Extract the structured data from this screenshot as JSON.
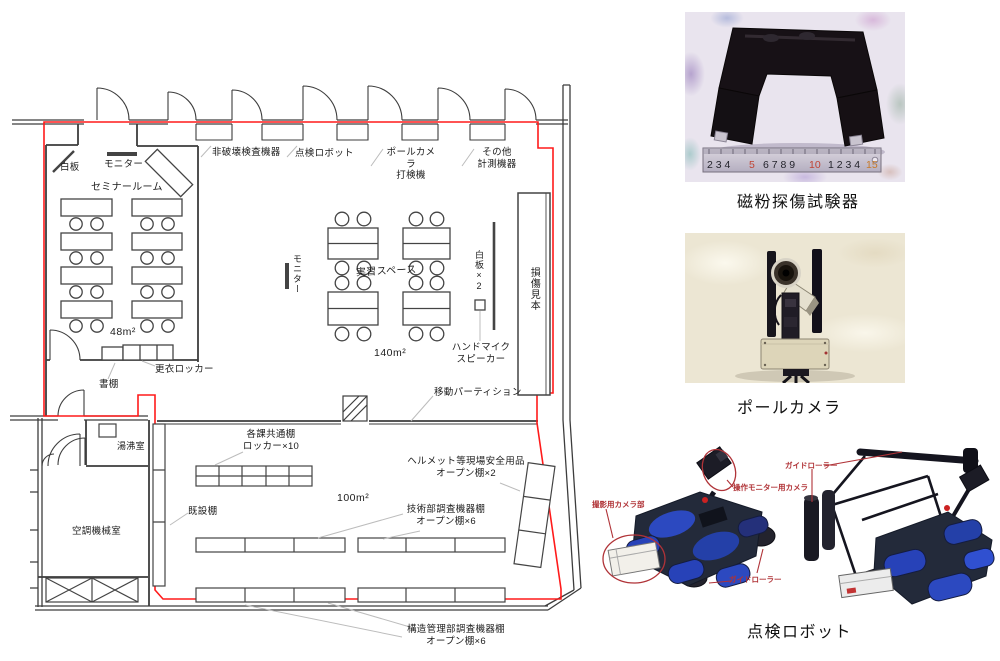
{
  "colors": {
    "boundary_red": "#ff1a1a",
    "wall_gray": "#3d3d3d",
    "leader_gray": "#bcbcbc",
    "annotation_red": "#b03236",
    "robot_blue": "#2742b8"
  },
  "plan": {
    "seminar_room": "セミナールーム",
    "seminar_area": "48m²",
    "whiteboard": "白板",
    "monitor": "モニター",
    "bookshelf": "書棚",
    "change_locker": "更衣ロッカー",
    "ndt_equipment": "非破壊検査機器",
    "inspection_robot": "点検ロボット",
    "pole_camera": "ポールカメラ",
    "tapping_machine": "打検機",
    "other1": "その他",
    "other2": "計測機器",
    "training_space": "実習スペース",
    "training_area": "140m²",
    "monitor2": "モニター",
    "whiteboards2": "白板×2",
    "handmic": "ハンドマイク",
    "speaker": "スピーカー",
    "damage_sample": "損傷見本",
    "partition": "移動パーティション",
    "hot_water_room": "湯沸室",
    "hvac_room": "空調機械室",
    "main_area": "100m²",
    "existing_shelf": "既設棚",
    "common_shelf1": "各課共通棚",
    "common_shelf2": "ロッカー×10",
    "helmet1": "ヘルメット等現場安全用品",
    "helmet2": "オープン棚×2",
    "tech1": "技術部調査機器棚",
    "tech2": "オープン棚×6",
    "struct1": "構造管理部調査機器棚",
    "struct2": "オープン棚×6"
  },
  "photos": {
    "p1_caption": "磁粉探傷試験器",
    "ruler": {
      "s1": "2 3 4",
      "s2": "5",
      "s3": "6 7 8 9",
      "s4": "10",
      "s5": "1 2 3 4",
      "s6": "15"
    },
    "p2_caption": "ポールカメラ",
    "p3_caption": "点検ロボット",
    "ann_camera_unit": "撮影用カメラ部",
    "ann_monitor_camera": "操作モニター用カメラ",
    "ann_guide_roller_left": "ガイドローラー",
    "ann_guide_roller_right": "ガイドローラー"
  }
}
